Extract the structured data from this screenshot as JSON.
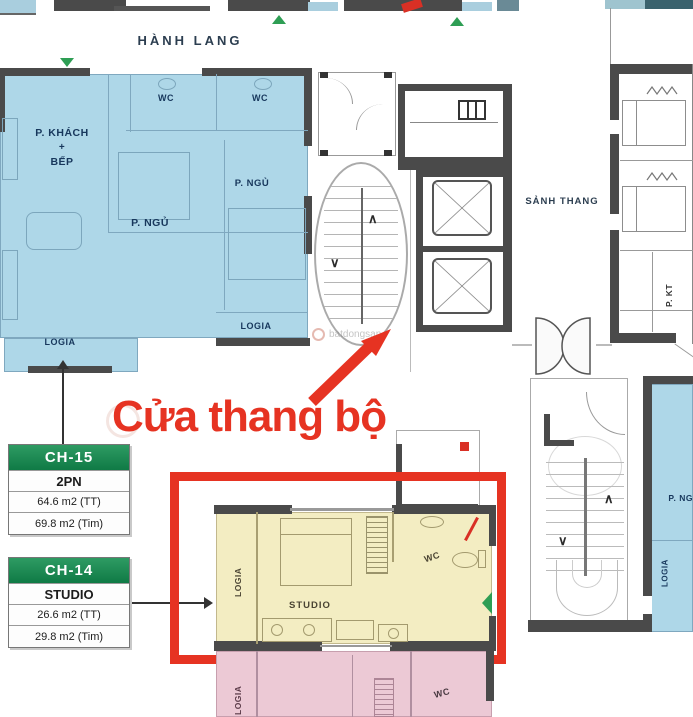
{
  "corridor": {
    "label": "HÀNH LANG"
  },
  "lobby": {
    "label": "SẢNH THANG"
  },
  "unit_2pn": {
    "wc_left": "WC",
    "wc_right": "WC",
    "living_line1": "P. KHÁCH",
    "living_plus": "+",
    "living_line2": "BẾP",
    "bedroom_center": "P. NGỦ",
    "bedroom_right": "P. NGỦ",
    "logia_left": "LOGIA",
    "logia_right": "LOGIA"
  },
  "right_unit": {
    "pkt": "P. KT"
  },
  "studio_unit": {
    "logia": "LOGIA",
    "name": "STUDIO",
    "wc": "WC"
  },
  "pink_unit": {
    "logia": "LOGIA",
    "wc": "WC"
  },
  "bottom_right_unit": {
    "bedroom": "P. NGỦ",
    "logia": "LOGIA"
  },
  "annotation": {
    "text": "Cửa thang bộ"
  },
  "watermark": {
    "text": "batdongsan"
  },
  "glyphs": {
    "chevron_up": "∧",
    "chevron_down": "∨"
  },
  "info_boxes": [
    {
      "code": "CH-15",
      "type": "2PN",
      "area_tt": "64.6 m2 (TT)",
      "area_tim": "69.8 m2 (Tim)"
    },
    {
      "code": "CH-14",
      "type": "STUDIO",
      "area_tt": "26.6 m2 (TT)",
      "area_tim": "29.8 m2 (Tim)"
    }
  ],
  "colors": {
    "accent_red": "#E63322",
    "unit_blue": "#AED7E8",
    "unit_yellow": "#F3EDC2",
    "unit_pink": "#ECC9D5",
    "green_header": "#0F7A45",
    "green_marker": "#2E9E54",
    "wall_dark": "#4A4A4A"
  }
}
